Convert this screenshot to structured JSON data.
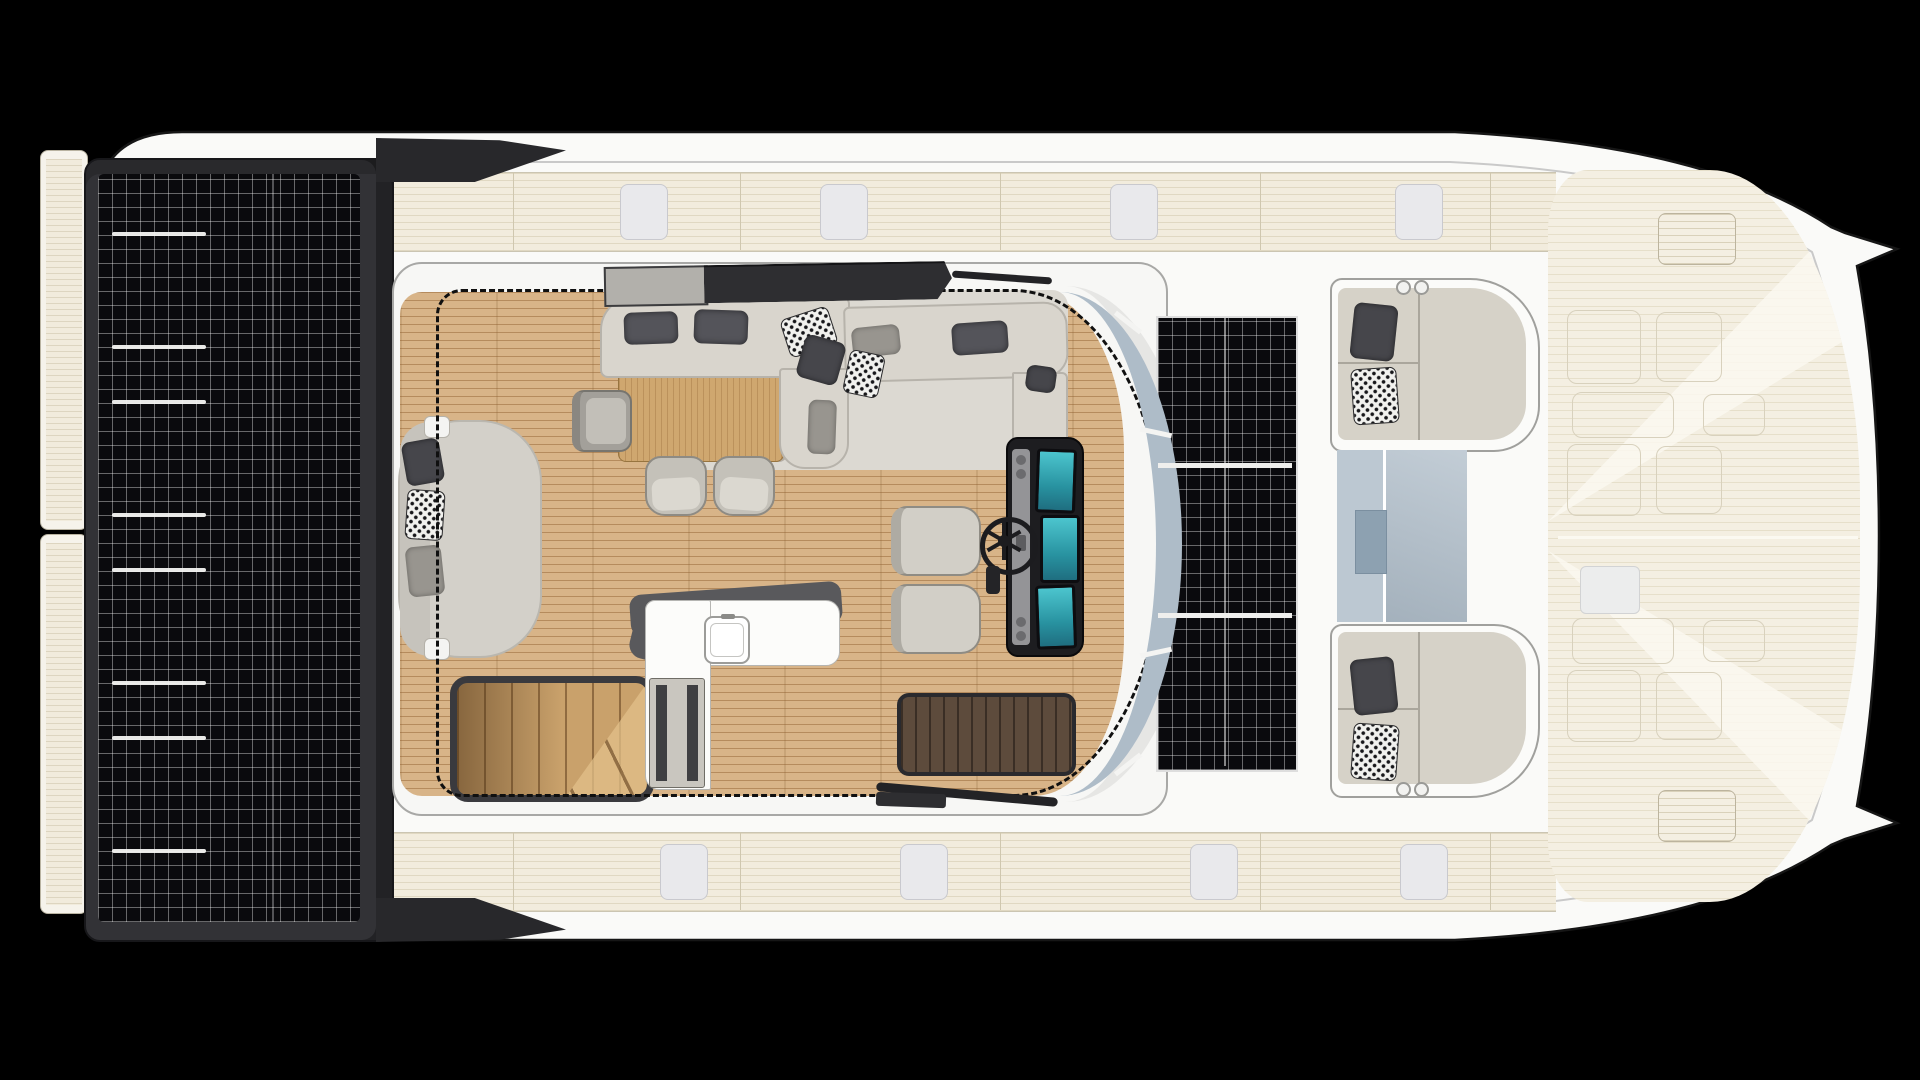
{
  "meta": {
    "title": "Catamaran motor yacht — flybridge / main deck floor plan, top-down view",
    "canvas": {
      "width": 1920,
      "height": 1080
    },
    "visible_text": "none — purely graphical deck plan"
  },
  "palette": {
    "bg": "#000000",
    "hull": "#fafaf8",
    "hull-line": "#161616",
    "inner-line": "#c9c9c9",
    "deck": "#f2ecdd",
    "deck-line": "#e0d8c2",
    "bow-deck": "#f4efe2",
    "hatch": "#e9e9ec",
    "hatch-line": "#c9c9ce",
    "solar-frame": "#323236",
    "solar-cell": "#0a0a0d",
    "solar-grid": "rgba(255,255,255,0.38)",
    "wood": "#d8b488",
    "table": "#cfa76f",
    "sofa": "#d9d5cd",
    "sofa-line": "#b7b3ab",
    "cushion": "#54545a",
    "rug": "#dcd9d2",
    "lounge": "#d3d0c9",
    "glass": "#aebcc8",
    "glass-light": "#bcc8d2",
    "glass-dark": "#8da1b1",
    "console": "#1d1d20",
    "screen": "#35b6c0",
    "dark-rug": "#5d4b3c",
    "counter-edge": "#59595c",
    "stairs": "#c9a16b",
    "wing": "#28282b",
    "seat": "#d6d2c8",
    "seat-shell": "#fbfbf9"
  },
  "labels": {
    "scene": "Catamaran yacht flybridge deck plan (top view, bow to the right)",
    "hull": "Yacht hull silhouette with twin bow tips",
    "aft_solar": "Aft hardtop solar panel array",
    "center_solar": "Coachroof solar panel, 3 stacked modules",
    "swim_platform": "Aft platform steps",
    "side_deck_port": "Port side deck with deck hatches",
    "side_deck_starboard": "Starboard side deck with deck hatches",
    "bow": "Foredeck with storage hatches",
    "salon": "Open flybridge salon with teak floor",
    "rug": "Light salon carpet",
    "l_sofa": "L-shaped settee with cushions and throw pillows",
    "dining_table": "Teak dining table",
    "chairs": "Dining chairs",
    "lounge": "Curved lounge day-bed with pillows",
    "stairs": "Teak staircase to main deck",
    "galley": "Wet bar with sink",
    "bench": "Storage bench beside wet bar",
    "companionway": "Dark teak companionway mat",
    "helm": "Helm station — twin seats, steering wheel, 3 chart displays",
    "windshield": "Wraparound windshield glazing",
    "canvas_outline": "Dashed hardtop / bimini outline",
    "sunroof": "Sliding sunroof panel",
    "fwd_seat_top": "Forward cockpit settee (starboard)",
    "fwd_seat_bottom": "Forward cockpit settee (port)",
    "skylight": "Forward salon skylight glazing",
    "rails": "Roof grab rails / wiper arms"
  },
  "solar": {
    "left_bus_bars_y": [
      232,
      345,
      400,
      513,
      568,
      681,
      736,
      849
    ],
    "left_bus_bar_x": 112,
    "left_bus_bar_w": 94,
    "center_separators_y": [
      463,
      613
    ],
    "center_module_count": 3
  },
  "decks": {
    "top_hatch_xs": [
      620,
      820,
      1110,
      1395
    ],
    "bottom_hatch_xs": [
      660,
      900,
      1190,
      1400
    ],
    "divider_xs": [
      513,
      740,
      1000,
      1260,
      1490
    ],
    "top_band": {
      "y": 172,
      "h": 78
    },
    "bottom_band": {
      "y": 832,
      "h": 78
    }
  },
  "bow_hatches": [
    {
      "x": 1658,
      "y": 213,
      "w": 76,
      "h": 50,
      "kind": "plank"
    },
    {
      "x": 1567,
      "y": 310,
      "w": 72,
      "h": 72,
      "kind": "plain"
    },
    {
      "x": 1656,
      "y": 312,
      "w": 64,
      "h": 68,
      "kind": "plain"
    },
    {
      "x": 1572,
      "y": 392,
      "w": 100,
      "h": 44,
      "kind": "plain"
    },
    {
      "x": 1703,
      "y": 394,
      "w": 60,
      "h": 40,
      "kind": "plain"
    },
    {
      "x": 1567,
      "y": 444,
      "w": 72,
      "h": 70,
      "kind": "plain"
    },
    {
      "x": 1656,
      "y": 446,
      "w": 64,
      "h": 66,
      "kind": "plain"
    },
    {
      "x": 1580,
      "y": 566,
      "w": 58,
      "h": 46,
      "kind": "light"
    },
    {
      "x": 1572,
      "y": 618,
      "w": 100,
      "h": 44,
      "kind": "plain"
    },
    {
      "x": 1703,
      "y": 620,
      "w": 60,
      "h": 40,
      "kind": "plain"
    },
    {
      "x": 1567,
      "y": 670,
      "w": 72,
      "h": 70,
      "kind": "plain"
    },
    {
      "x": 1656,
      "y": 672,
      "w": 64,
      "h": 66,
      "kind": "plain"
    },
    {
      "x": 1658,
      "y": 790,
      "w": 76,
      "h": 50,
      "kind": "plank"
    }
  ]
}
